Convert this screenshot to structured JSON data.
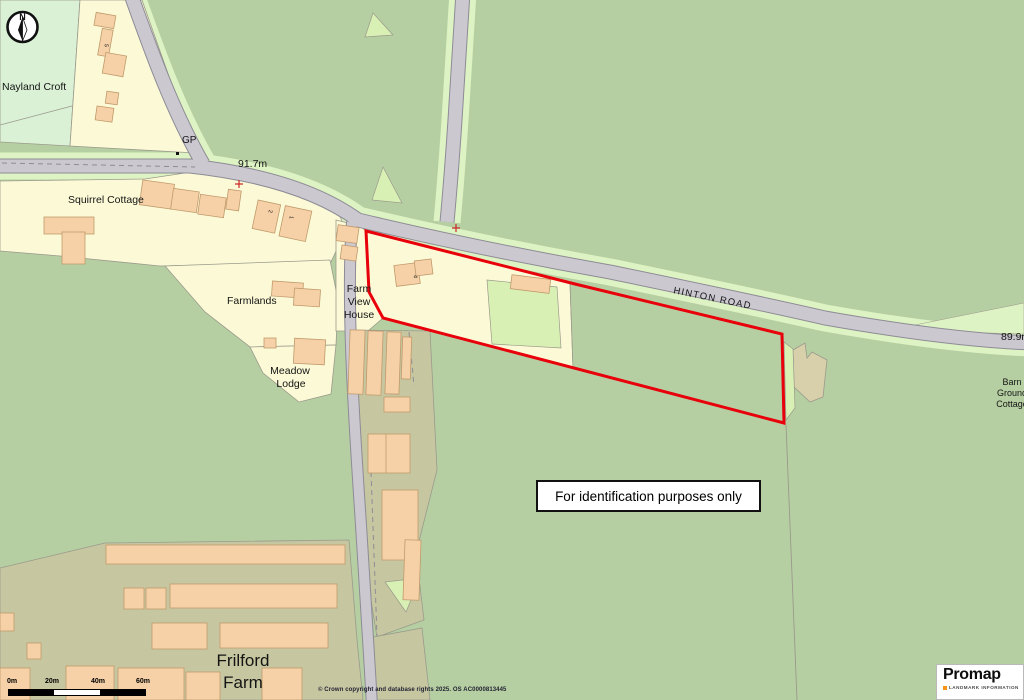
{
  "map": {
    "labels": {
      "nayland_croft": "Nayland Croft",
      "gp": "GP",
      "spot_height_1": "91.7m",
      "squirrel_cottage": "Squirrel Cottage",
      "farmlands": "Farmlands",
      "meadow_lodge_line1": "Meadow",
      "meadow_lodge_line2": "Lodge",
      "farm_view_line1": "Farm",
      "farm_view_line2": "View",
      "farm_view_line3": "House",
      "hinton_road": "HINTON ROAD",
      "spot_height_2": "89.9m",
      "barn_ground_line1": "Barn",
      "barn_ground_line2": "Ground",
      "barn_ground_line3": "Cottage",
      "frilford_line1": "Frilford",
      "frilford_line2": "Farm",
      "plot_number_4": "4",
      "house_number_5": "5",
      "house_number_2": "2",
      "house_number_1": "1",
      "compass_north": "N"
    },
    "notice": "For identification purposes only",
    "scale_bar": {
      "ticks": [
        "0m",
        "20m",
        "40m",
        "60m"
      ]
    },
    "copyright": "© Crown copyright and database rights 2025. OS AC0000813445",
    "branding": {
      "logo": "Promap",
      "tagline": "LANDMARK INFORMATION"
    },
    "colors": {
      "site_boundary_red": "#e8000b",
      "field_green": "#b6cfa2",
      "verge_green": "#def3c3",
      "parcel_cream": "#fcfad6",
      "parcel_mint": "#daf1d6",
      "building_peach": "#f6d1a8",
      "farmyard_olive": "#c6c7a0",
      "road_grey": "#cbc8d0",
      "landmark_orange": "#f7941d"
    }
  }
}
